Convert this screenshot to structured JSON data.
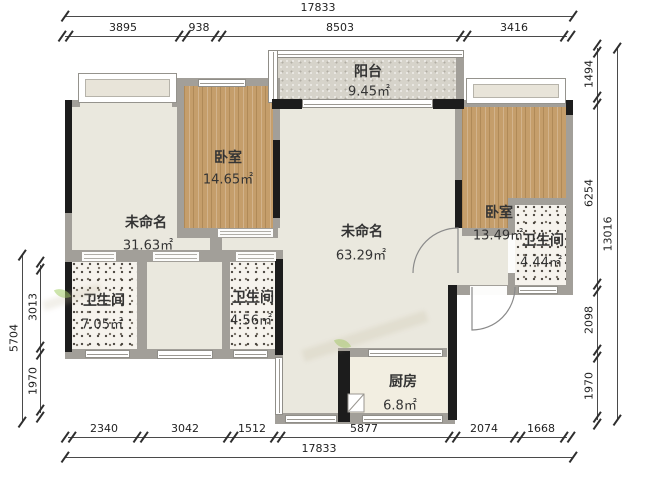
{
  "rooms": {
    "balcony": {
      "name": "阳台",
      "area": "9.45㎡"
    },
    "bedroom_left": {
      "name": "卧室",
      "area": "14.65㎡"
    },
    "unnamed_left": {
      "name": "未命名",
      "area": "31.63㎡"
    },
    "unnamed_main": {
      "name": "未命名",
      "area": "63.29㎡"
    },
    "bedroom_right": {
      "name": "卧室",
      "area": "13.49㎡"
    },
    "bath_right": {
      "name": "卫生间",
      "area": "4.44㎡"
    },
    "bath_left": {
      "name": "卫生间",
      "area": "7.05㎡"
    },
    "bath_mid": {
      "name": "卫生间",
      "area": "4.56㎡"
    },
    "kitchen": {
      "name": "厨房",
      "area": "6.8㎡"
    }
  },
  "dimensions": {
    "top": {
      "total": "17833",
      "segments": [
        "3895",
        "938",
        "8503",
        "3416"
      ]
    },
    "bottom": {
      "total": "17833",
      "segments": [
        "2340",
        "3042",
        "1512",
        "5877",
        "2074",
        "1668"
      ]
    },
    "left": {
      "total": "5704",
      "segments": [
        "3013",
        "1970"
      ]
    },
    "right": {
      "total": "13016",
      "segments": [
        "1494",
        "6254",
        "2098",
        "1970"
      ]
    }
  },
  "colors": {
    "wall_gray": "#a29f99",
    "wall_black": "#1c1c1c",
    "room_beige": "#eae8de",
    "wood": "#c59e6b",
    "balcony_gray": "#d6d3ca",
    "kitchen_cream": "#f2eee1",
    "speckle_bg": "#f6f3ed",
    "dim_text": "#1f1f1f",
    "watermark_green": "#9ccb5a"
  }
}
